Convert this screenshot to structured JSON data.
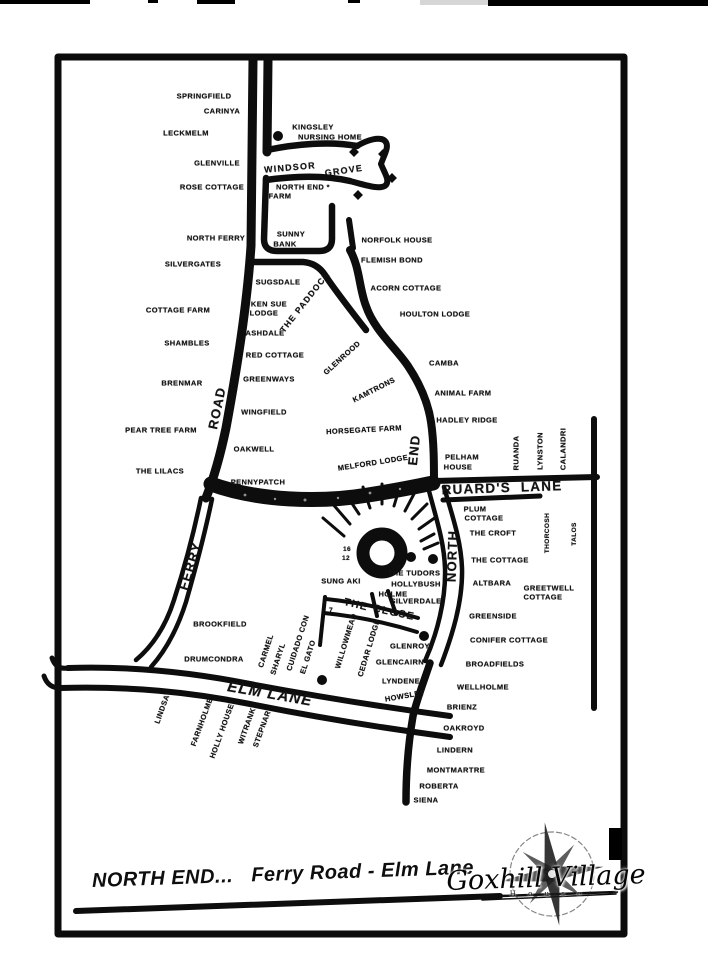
{
  "map": {
    "caption": "NORTH END...   Ferry Road - Elm Lane",
    "logo": {
      "name": "Goxhill Village",
      "subtitle": "H o u s e"
    },
    "labels": [
      {
        "t": "SPRINGFIELD",
        "x": 204,
        "y": 96
      },
      {
        "t": "CARINYA",
        "x": 222,
        "y": 111
      },
      {
        "t": "LECKMELM",
        "x": 186,
        "y": 133
      },
      {
        "t": "KINGSLEY",
        "x": 313,
        "y": 127
      },
      {
        "t": "NURSING HOME",
        "x": 330,
        "y": 137
      },
      {
        "t": "GLENVILLE",
        "x": 217,
        "y": 163
      },
      {
        "t": "WINDSOR",
        "x": 290,
        "y": 168,
        "r": -5,
        "s": 9,
        "cls": "road"
      },
      {
        "t": "GROVE",
        "x": 344,
        "y": 171,
        "r": -8,
        "s": 9,
        "cls": "road"
      },
      {
        "t": "ROSE COTTAGE",
        "x": 212,
        "y": 187
      },
      {
        "t": "NORTH END *",
        "x": 303,
        "y": 187
      },
      {
        "t": "FARM",
        "x": 280,
        "y": 196
      },
      {
        "t": "NORTH FERRY",
        "x": 216,
        "y": 238
      },
      {
        "t": "SUNNY",
        "x": 291,
        "y": 234
      },
      {
        "t": "BANK",
        "x": 285,
        "y": 244
      },
      {
        "t": "NORFOLK HOUSE",
        "x": 397,
        "y": 240
      },
      {
        "t": "SILVERGATES",
        "x": 193,
        "y": 264
      },
      {
        "t": "FLEMISH BOND",
        "x": 392,
        "y": 260
      },
      {
        "t": "SUGSDALE",
        "x": 278,
        "y": 282
      },
      {
        "t": "ACORN COTTAGE",
        "x": 406,
        "y": 288
      },
      {
        "t": "KEN SUE",
        "x": 269,
        "y": 304
      },
      {
        "t": "LODGE",
        "x": 264,
        "y": 313
      },
      {
        "t": "THE PADDOCK",
        "x": 305,
        "y": 302,
        "r": -52,
        "s": 8.5,
        "cls": "road"
      },
      {
        "t": "HOULTON LODGE",
        "x": 435,
        "y": 314
      },
      {
        "t": "COTTAGE FARM",
        "x": 178,
        "y": 310
      },
      {
        "t": "ASHDALE",
        "x": 265,
        "y": 333
      },
      {
        "t": "SHAMBLES",
        "x": 187,
        "y": 343
      },
      {
        "t": "RED COTTAGE",
        "x": 275,
        "y": 355
      },
      {
        "t": "GLENROOD",
        "x": 342,
        "y": 358,
        "r": -42
      },
      {
        "t": "GREENWAYS",
        "x": 269,
        "y": 379
      },
      {
        "t": "BRENMAR",
        "x": 182,
        "y": 383
      },
      {
        "t": "KAMTRONS",
        "x": 374,
        "y": 390,
        "r": -27
      },
      {
        "t": "CAMBA",
        "x": 444,
        "y": 363
      },
      {
        "t": "ANIMAL FARM",
        "x": 463,
        "y": 393
      },
      {
        "t": "WINGFIELD",
        "x": 264,
        "y": 412
      },
      {
        "t": "HADLEY RIDGE",
        "x": 467,
        "y": 420
      },
      {
        "t": "PEAR TREE FARM",
        "x": 161,
        "y": 430
      },
      {
        "t": "HORSEGATE FARM",
        "x": 364,
        "y": 430,
        "r": -3
      },
      {
        "t": "ROAD",
        "x": 217,
        "y": 408,
        "r": -78,
        "s": 13,
        "cls": "road"
      },
      {
        "t": "FERRY",
        "x": 190,
        "y": 566,
        "r": -73,
        "s": 13,
        "cls": "road"
      },
      {
        "t": "END",
        "x": 414,
        "y": 450,
        "r": -84,
        "s": 13,
        "cls": "road"
      },
      {
        "t": "OAKWELL",
        "x": 254,
        "y": 449
      },
      {
        "t": "RUANDA",
        "x": 516,
        "y": 453,
        "r": -90
      },
      {
        "t": "LYNSTON",
        "x": 540,
        "y": 451,
        "r": -90
      },
      {
        "t": "CALANDRI",
        "x": 563,
        "y": 449,
        "r": -90
      },
      {
        "t": "PELHAM",
        "x": 462,
        "y": 457
      },
      {
        "t": "HOUSE",
        "x": 458,
        "y": 467
      },
      {
        "t": "THE LILACS",
        "x": 160,
        "y": 471
      },
      {
        "t": "MELFORD LODGE",
        "x": 373,
        "y": 463,
        "r": -9
      },
      {
        "t": "PENNYPATCH",
        "x": 258,
        "y": 482
      },
      {
        "t": "RUARD'S  LANE",
        "x": 502,
        "y": 488,
        "r": -2,
        "s": 13.5,
        "cls": "road"
      },
      {
        "t": "PLUM",
        "x": 475,
        "y": 509
      },
      {
        "t": "COTTAGE",
        "x": 484,
        "y": 518
      },
      {
        "t": "THE CROFT",
        "x": 493,
        "y": 533
      },
      {
        "t": "THORCOSH",
        "x": 548,
        "y": 533,
        "r": -90,
        "s": 6.5
      },
      {
        "t": "TALOS",
        "x": 575,
        "y": 534,
        "r": -90,
        "s": 6.5
      },
      {
        "t": "THE COTTAGE",
        "x": 500,
        "y": 560
      },
      {
        "t": "NORTH",
        "x": 452,
        "y": 556,
        "r": -88,
        "s": 13,
        "cls": "road"
      },
      {
        "t": "ALTBARA",
        "x": 492,
        "y": 583
      },
      {
        "t": "GREETWELL",
        "x": 549,
        "y": 588
      },
      {
        "t": "COTTAGE",
        "x": 543,
        "y": 597
      },
      {
        "t": "THE TUDORS",
        "x": 414,
        "y": 573
      },
      {
        "t": "HOLLYBUSH",
        "x": 416,
        "y": 584
      },
      {
        "t": "HOLME",
        "x": 393,
        "y": 594
      },
      {
        "t": "SILVERDALE",
        "x": 416,
        "y": 601
      },
      {
        "t": "SUNG AKI",
        "x": 341,
        "y": 581
      },
      {
        "t": "16",
        "x": 347,
        "y": 550,
        "s": 6.5
      },
      {
        "t": "12",
        "x": 346,
        "y": 559,
        "s": 6.5
      },
      {
        "t": "GREENSIDE",
        "x": 493,
        "y": 616
      },
      {
        "t": "THE",
        "x": 356,
        "y": 605,
        "r": 14,
        "s": 10.5,
        "cls": "road"
      },
      {
        "t": "CLOSE",
        "x": 394,
        "y": 613,
        "r": 12,
        "s": 10.5,
        "cls": "road"
      },
      {
        "t": "7",
        "x": 331,
        "y": 611,
        "s": 7
      },
      {
        "t": "BROOKFIELD",
        "x": 220,
        "y": 624
      },
      {
        "t": "WILLOWMEAD",
        "x": 346,
        "y": 641,
        "r": -73
      },
      {
        "t": "CEDAR LODGE",
        "x": 369,
        "y": 648,
        "r": -73
      },
      {
        "t": "GLENROY",
        "x": 410,
        "y": 646
      },
      {
        "t": "GLENCAIRN",
        "x": 400,
        "y": 662
      },
      {
        "t": "DRUMCONDRA",
        "x": 214,
        "y": 659
      },
      {
        "t": "CARMEL",
        "x": 266,
        "y": 651,
        "r": -72
      },
      {
        "t": "SHARYL",
        "x": 278,
        "y": 659,
        "r": -72
      },
      {
        "t": "CUIDADO CON",
        "x": 298,
        "y": 643,
        "r": -72
      },
      {
        "t": "EL GATO",
        "x": 308,
        "y": 657,
        "r": -72
      },
      {
        "t": "CONIFER COTTAGE",
        "x": 509,
        "y": 640
      },
      {
        "t": "BROADFIELDS",
        "x": 495,
        "y": 664
      },
      {
        "t": "LYNDENE",
        "x": 401,
        "y": 681
      },
      {
        "t": "WELLHOLME",
        "x": 483,
        "y": 687
      },
      {
        "t": "ELM LANE",
        "x": 270,
        "y": 694,
        "r": 10,
        "s": 15,
        "cls": "road",
        "i": 1
      },
      {
        "t": "HOWSLEY",
        "x": 405,
        "y": 696,
        "r": -10
      },
      {
        "t": "BRIENZ",
        "x": 462,
        "y": 707
      },
      {
        "t": "OAKROYD",
        "x": 464,
        "y": 728
      },
      {
        "t": "LINDERN",
        "x": 455,
        "y": 750
      },
      {
        "t": "MONTMARTRE",
        "x": 456,
        "y": 770
      },
      {
        "t": "ROBERTA",
        "x": 439,
        "y": 786
      },
      {
        "t": "SIENA",
        "x": 426,
        "y": 800
      },
      {
        "t": "LINDSAY",
        "x": 163,
        "y": 707,
        "r": -70
      },
      {
        "t": "FARNHOLME",
        "x": 202,
        "y": 722,
        "r": -70
      },
      {
        "t": "HOLLY HOUSE",
        "x": 222,
        "y": 731,
        "r": -70
      },
      {
        "t": "WITRANK",
        "x": 247,
        "y": 726,
        "r": -70
      },
      {
        "t": "STEPNAR",
        "x": 262,
        "y": 729,
        "r": -70
      }
    ],
    "symbols": [
      {
        "type": "dot",
        "x": 278,
        "y": 136
      },
      {
        "type": "dot",
        "x": 411,
        "y": 557
      },
      {
        "type": "dot",
        "x": 433,
        "y": 559
      },
      {
        "type": "dot",
        "x": 424,
        "y": 636
      },
      {
        "type": "dot",
        "x": 322,
        "y": 680
      },
      {
        "type": "diamond",
        "x": 354,
        "y": 152
      },
      {
        "type": "diamond",
        "x": 383,
        "y": 154
      },
      {
        "type": "diamond",
        "x": 392,
        "y": 178
      },
      {
        "type": "diamond",
        "x": 358,
        "y": 195
      }
    ]
  }
}
